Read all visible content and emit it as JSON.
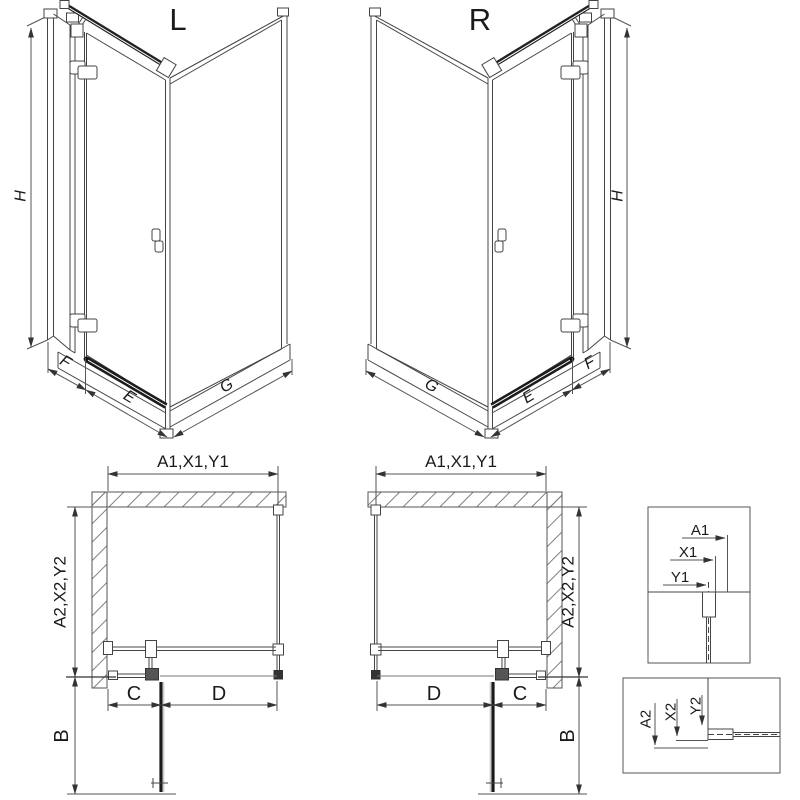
{
  "views": {
    "iso_left": {
      "title": "L",
      "height_dim": "H",
      "fixed_dim": "F",
      "door_dim": "E",
      "side_dim": "G"
    },
    "iso_right": {
      "title": "R",
      "height_dim": "H",
      "fixed_dim": "F",
      "door_dim": "E",
      "side_dim": "G"
    },
    "plan_left": {
      "width_dim": "A1,X1,Y1",
      "depth_dim": "A2,X2,Y2",
      "c_dim": "C",
      "d_dim": "D",
      "door_width_dim": "B"
    },
    "plan_right": {
      "width_dim": "A1,X1,Y1",
      "depth_dim": "A2,X2,Y2",
      "c_dim": "C",
      "d_dim": "D",
      "door_width_dim": "B"
    },
    "detail_width": {
      "a": "A1",
      "x": "X1",
      "y": "Y1"
    },
    "detail_depth": {
      "a": "A2",
      "x": "X2",
      "y": "Y2"
    }
  },
  "colors": {
    "background": "#ffffff",
    "line": "#444444",
    "dim_line": "#555555",
    "dark": "#1a1a1a",
    "hatch": "#808080"
  }
}
